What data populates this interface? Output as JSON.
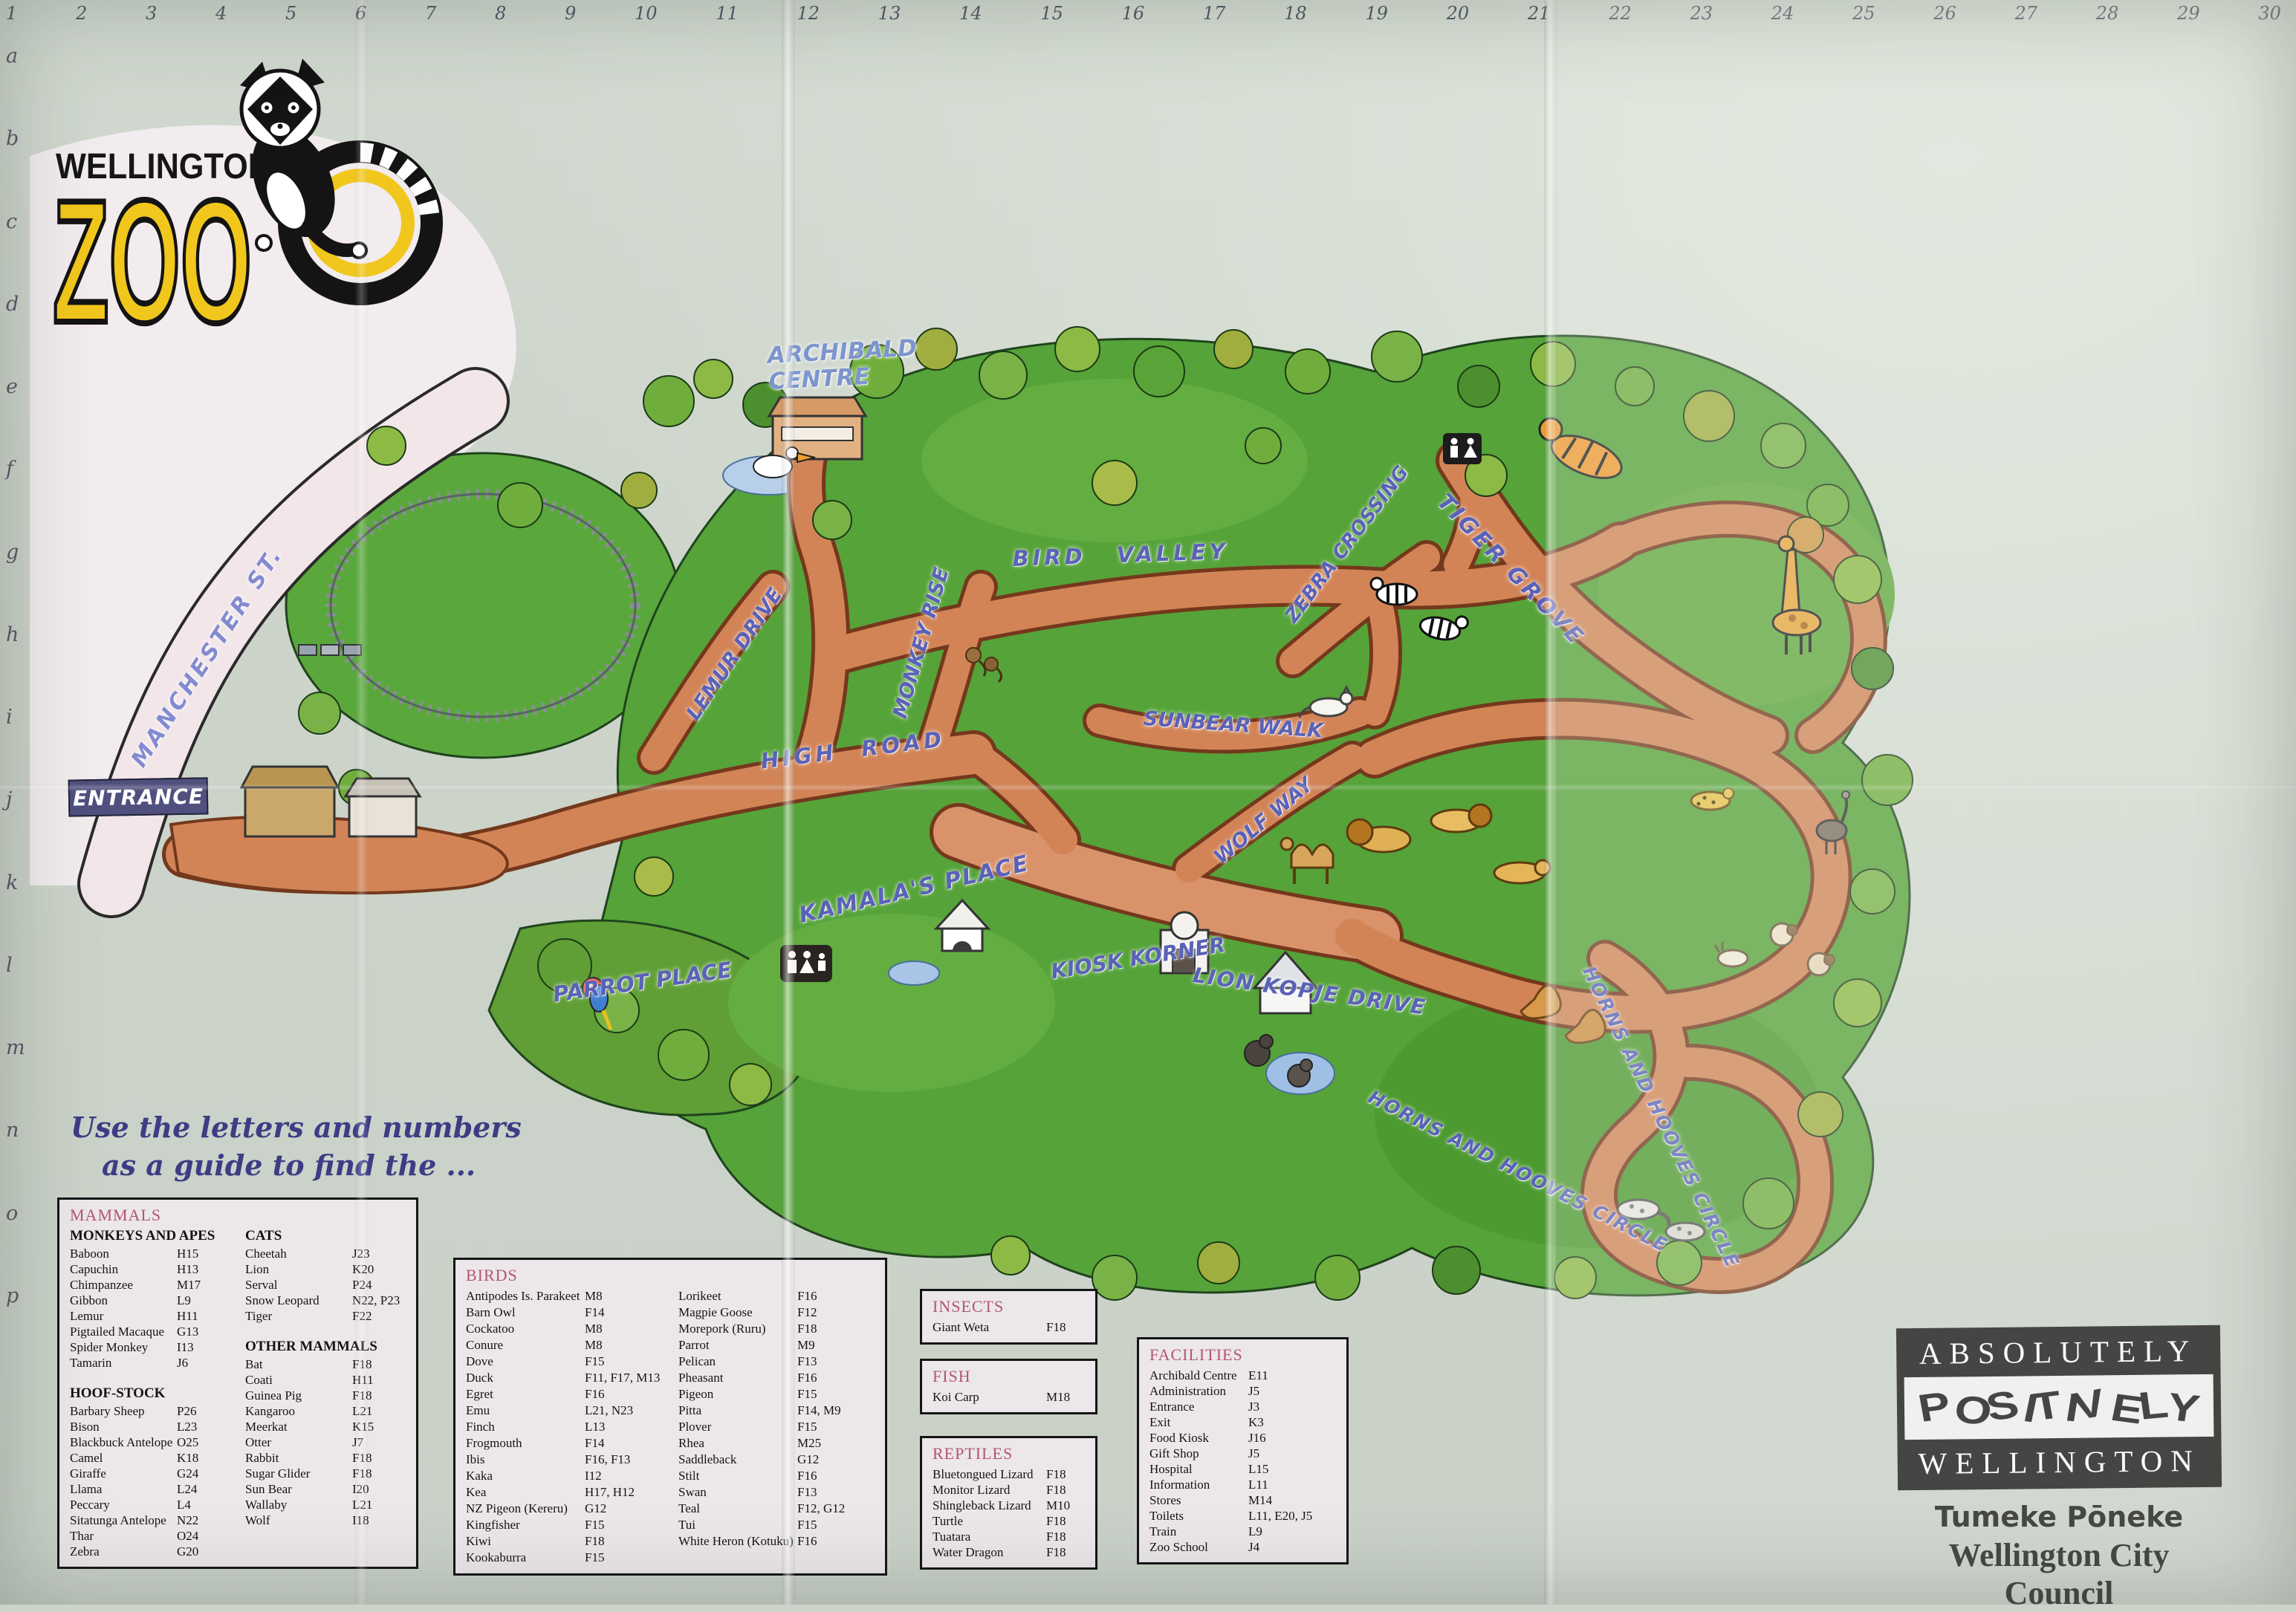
{
  "grid": {
    "numbers": [
      "1",
      "2",
      "3",
      "4",
      "5",
      "6",
      "7",
      "8",
      "9",
      "10",
      "11",
      "12",
      "13",
      "14",
      "15",
      "16",
      "17",
      "18",
      "19",
      "20",
      "21",
      "22",
      "23",
      "24",
      "25",
      "26",
      "27",
      "28",
      "29",
      "30"
    ],
    "letters": [
      "a",
      "b",
      "c",
      "d",
      "e",
      "f",
      "g",
      "h",
      "i",
      "j",
      "k",
      "l",
      "m",
      "n",
      "o",
      "p"
    ]
  },
  "logo": {
    "city": "WELLINGTON",
    "zoo": "ZOO"
  },
  "instructions": {
    "line1": "Use the letters and numbers",
    "line2": "as a guide to find the ..."
  },
  "map": {
    "entrance_sign": "ENTRANCE",
    "labels": {
      "manchester": "MANCHESTER ST.",
      "archibald": "ARCHIBALD CENTRE",
      "bird_valley": "BIRD VALLEY",
      "monkey_rise": "MONKEY RISE",
      "lemur_drive": "LEMUR DRIVE",
      "high_road": "HIGH ROAD",
      "kamalas_place": "KAMALA'S PLACE",
      "parrot_place": "PARROT PLACE",
      "kiosk_korner": "KIOSK KORNER",
      "sunbear_walk": "SUNBEAR WALK",
      "wolf_way": "WOLF WAY",
      "zebra_crossing": "ZEBRA CROSSING",
      "tiger_grove": "TIGER GROVE",
      "lion_kopje_drive": "LION KOPJE DRIVE",
      "horns_hooves_1": "HORNS AND HOOVES CIRCLE",
      "horns_hooves_2": "HORNS AND HOOVES CIRCLE"
    }
  },
  "legend": {
    "mammals": {
      "title": "MAMMALS",
      "monkeys_heading": "MONKEYS AND APES",
      "monkeys": [
        [
          "Baboon",
          "H15"
        ],
        [
          "Capuchin",
          "H13"
        ],
        [
          "Chimpanzee",
          "M17"
        ],
        [
          "Gibbon",
          "L9"
        ],
        [
          "Lemur",
          "H11"
        ],
        [
          "Pigtailed Macaque",
          "G13"
        ],
        [
          "Spider Monkey",
          "I13"
        ],
        [
          "Tamarin",
          "J6"
        ]
      ],
      "hoof_heading": "HOOF-STOCK",
      "hoof": [
        [
          "Barbary Sheep",
          "P26"
        ],
        [
          "Bison",
          "L23"
        ],
        [
          "Blackbuck Antelope",
          "O25"
        ],
        [
          "Camel",
          "K18"
        ],
        [
          "Giraffe",
          "G24"
        ],
        [
          "Llama",
          "L24"
        ],
        [
          "Peccary",
          "L4"
        ],
        [
          "Sitatunga Antelope",
          "N22"
        ],
        [
          "Thar",
          "O24"
        ],
        [
          "Zebra",
          "G20"
        ]
      ],
      "cats_heading": "CATS",
      "cats": [
        [
          "Cheetah",
          "J23"
        ],
        [
          "Lion",
          "K20"
        ],
        [
          "Serval",
          "P24"
        ],
        [
          "Snow Leopard",
          "N22, P23"
        ],
        [
          "Tiger",
          "F22"
        ]
      ],
      "other_heading": "OTHER MAMMALS",
      "other": [
        [
          "Bat",
          "F18"
        ],
        [
          "Coati",
          "H11"
        ],
        [
          "Guinea Pig",
          "F18"
        ],
        [
          "Kangaroo",
          "L21"
        ],
        [
          "Meerkat",
          "K15"
        ],
        [
          "Otter",
          "J7"
        ],
        [
          "Rabbit",
          "F18"
        ],
        [
          "Sugar Glider",
          "F18"
        ],
        [
          "Sun Bear",
          "I20"
        ],
        [
          "Wallaby",
          "L21"
        ],
        [
          "Wolf",
          "I18"
        ]
      ]
    },
    "birds": {
      "title": "BIRDS",
      "col1": [
        [
          "Antipodes Is. Parakeet",
          "M8"
        ],
        [
          "Barn Owl",
          "F14"
        ],
        [
          "Cockatoo",
          "M8"
        ],
        [
          "Conure",
          "M8"
        ],
        [
          "Dove",
          "F15"
        ],
        [
          "Duck",
          "F11, F17, M13"
        ],
        [
          "Egret",
          "F16"
        ],
        [
          "Emu",
          "L21, N23"
        ],
        [
          "Finch",
          "L13"
        ],
        [
          "Frogmouth",
          "F14"
        ],
        [
          "Ibis",
          "F16, F13"
        ],
        [
          "Kaka",
          "I12"
        ],
        [
          "Kea",
          "H17, H12"
        ],
        [
          "NZ Pigeon (Kereru)",
          "G12"
        ],
        [
          "Kingfisher",
          "F15"
        ],
        [
          "Kiwi",
          "F18"
        ],
        [
          "Kookaburra",
          "F15"
        ]
      ],
      "col2": [
        [
          "Lorikeet",
          "F16"
        ],
        [
          "Magpie Goose",
          "F12"
        ],
        [
          "Morepork (Ruru)",
          "F18"
        ],
        [
          "Parrot",
          "M9"
        ],
        [
          "Pelican",
          "F13"
        ],
        [
          "Pheasant",
          "F16"
        ],
        [
          "Pigeon",
          "F15"
        ],
        [
          "Pitta",
          "F14, M9"
        ],
        [
          "Plover",
          "F15"
        ],
        [
          "Rhea",
          "M25"
        ],
        [
          "Saddleback",
          "G12"
        ],
        [
          "Stilt",
          "F16"
        ],
        [
          "Swan",
          "F13"
        ],
        [
          "Teal",
          "F12, G12"
        ],
        [
          "Tui",
          "F15"
        ],
        [
          "White Heron (Kotuku)",
          "F16"
        ]
      ]
    },
    "insects": {
      "title": "INSECTS",
      "items": [
        [
          "Giant Weta",
          "F18"
        ]
      ]
    },
    "fish": {
      "title": "FISH",
      "items": [
        [
          "Koi Carp",
          "M18"
        ]
      ]
    },
    "reptiles": {
      "title": "REPTILES",
      "items": [
        [
          "Bluetongued Lizard",
          "F18"
        ],
        [
          "Monitor Lizard",
          "F18"
        ],
        [
          "Shingleback Lizard",
          "M10"
        ],
        [
          "Turtle",
          "F18"
        ],
        [
          "Tuatara",
          "F18"
        ],
        [
          "Water Dragon",
          "F18"
        ]
      ]
    },
    "facilities": {
      "title": "FACILITIES",
      "items": [
        [
          "Archibald Centre",
          "E11"
        ],
        [
          "Administration",
          "J5"
        ],
        [
          "Entrance",
          "J3"
        ],
        [
          "Exit",
          "K3"
        ],
        [
          "Food Kiosk",
          "J16"
        ],
        [
          "Gift Shop",
          "J5"
        ],
        [
          "Hospital",
          "L15"
        ],
        [
          "Information",
          "L11"
        ],
        [
          "Stores",
          "M14"
        ],
        [
          "Toilets",
          "L11, E20, J5"
        ],
        [
          "Train",
          "L9"
        ],
        [
          "Zoo School",
          "J4"
        ]
      ]
    }
  },
  "footer": {
    "brand_line1": "ABSOLUTELY",
    "brand_line2": "POSITIVELY",
    "brand_line3": "WELLINGTON",
    "tagline": "Tumeke Pōneke",
    "council": "Wellington City Council"
  }
}
